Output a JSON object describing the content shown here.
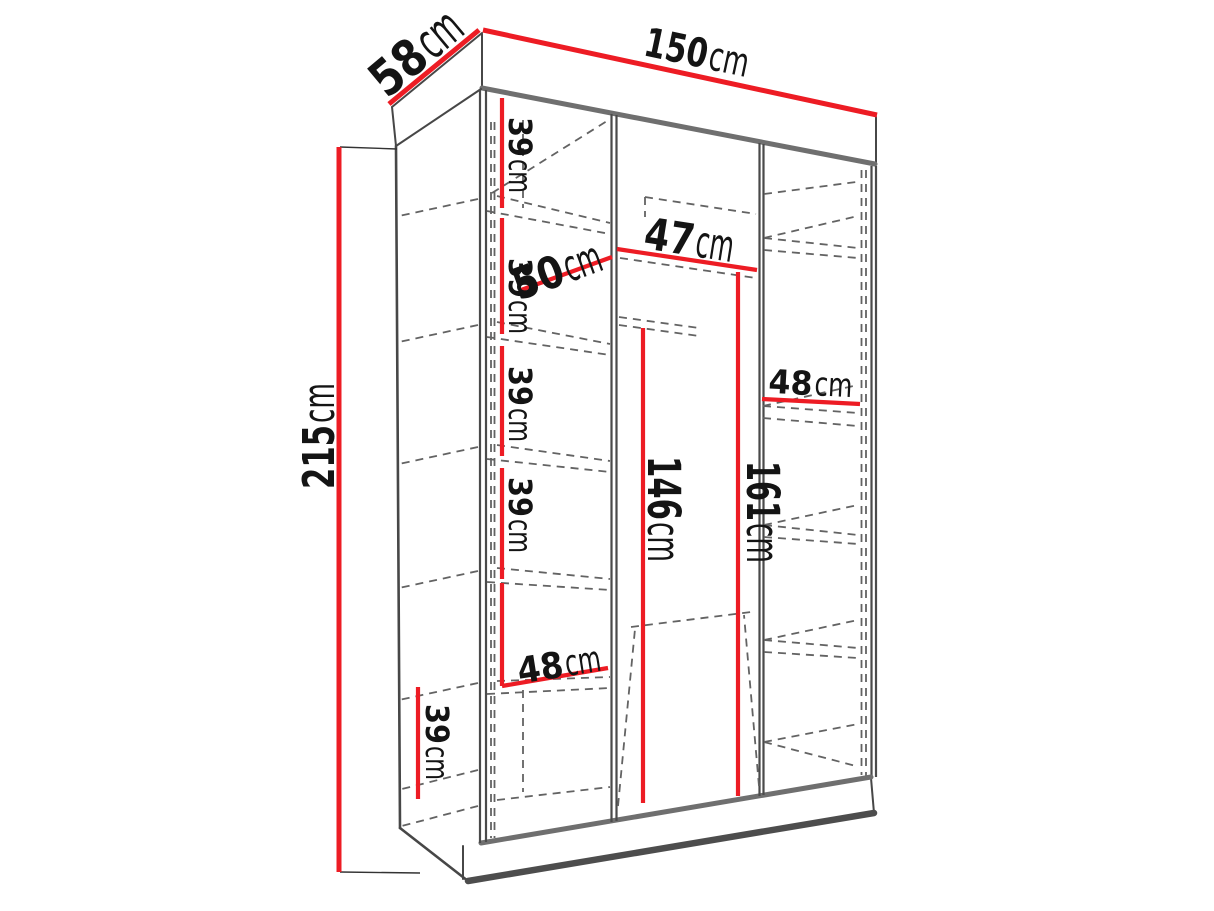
{
  "diagram": {
    "type": "wardrobe-dimension-drawing",
    "colors": {
      "dimension_line": "#ed1c24",
      "label_text": "#141414",
      "outline": "#474747",
      "hidden_line": "#636363",
      "background": "#ffffff"
    },
    "dims": {
      "width": {
        "num": "150",
        "unit": "cm"
      },
      "depth": {
        "num": "58",
        "unit": "cm"
      },
      "height": {
        "num": "215",
        "unit": "cm"
      },
      "shelf1": {
        "num": "39",
        "unit": "cm"
      },
      "shelf2": {
        "num": "39",
        "unit": "cm"
      },
      "shelf3": {
        "num": "39",
        "unit": "cm"
      },
      "shelf4": {
        "num": "39",
        "unit": "cm"
      },
      "left_width": {
        "num": "50",
        "unit": "cm"
      },
      "middle_width": {
        "num": "47",
        "unit": "cm"
      },
      "right_width": {
        "num": "48",
        "unit": "cm"
      },
      "hang_inner": {
        "num": "146",
        "unit": "cm"
      },
      "hang_outer": {
        "num": "161",
        "unit": "cm"
      },
      "bottom_width": {
        "num": "48",
        "unit": "cm"
      },
      "bottom_height": {
        "num": "39",
        "unit": "cm"
      }
    }
  }
}
